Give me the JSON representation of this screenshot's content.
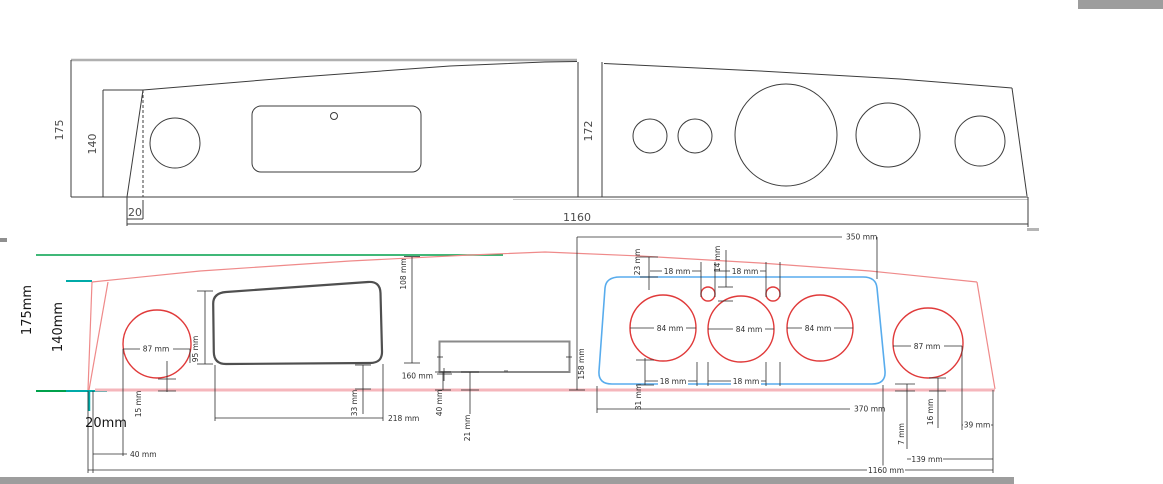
{
  "colors": {
    "cad_line": "#3c3c3c",
    "dim_line": "#2e2e2e",
    "outline_red": "#ef8a8a",
    "band_pink": "#f5b6bb",
    "circle_red": "#e03a3a",
    "green": "#00a14b",
    "teal": "#00aaa8",
    "blue_panel": "#58aced",
    "blue_text": "#3d9ae8",
    "red_text": "#e03a3a",
    "gray_bar": "#9d9d9d",
    "gray_frame": "#b0b0b0",
    "cluster_rect": "#4f4f4f",
    "radio_rect": "#8a8a8a"
  },
  "top_view": {
    "labels": {
      "height_total": "175",
      "height_front": "140",
      "center_height": "172",
      "bottom_offset": "20",
      "total_width": "1160"
    }
  },
  "bottom_view": {
    "labels": {
      "height_total": "175mm",
      "height_front": "140mm",
      "bottom_offset": "20mm",
      "left_gauge_dia": "87 mm",
      "left_gauge_gap": "15 mm",
      "left_edge_dist": "40 mm",
      "cluster_height": "95 mm",
      "cluster_height_right": "108 mm",
      "cluster_width": "218 mm",
      "cluster_bottom_gap": "33 mm",
      "radio_height": "160 mm",
      "radio_depth": "40 mm",
      "radio_bottom_gap": "21 mm",
      "mid_height": "158 mm",
      "gaugepanel_top_width": "350 mm",
      "gaugepanel_top_gap": "23 mm",
      "small_gauge_gap_left": "18 mm",
      "small_gauge_dia": "14 mm",
      "small_gauge_gap_right": "18 mm",
      "gauge1_dia": "84 mm",
      "gauge2_dia": "84 mm",
      "gauge3_dia": "84 mm",
      "gauge_gap_bottom_left": "18 mm",
      "gauge_gap_bottom_right": "18 mm",
      "gauge_bottom_offset": "31 mm",
      "gaugepanel_bottom_width": "370 mm",
      "right_gauge_dia": "87 mm",
      "corner_gap": "7 mm",
      "right_gauge_gap": "16 mm",
      "right_edge_gap": "39 mm",
      "right_edge_dist": "139 mm",
      "total_width": "1160 mm"
    }
  }
}
